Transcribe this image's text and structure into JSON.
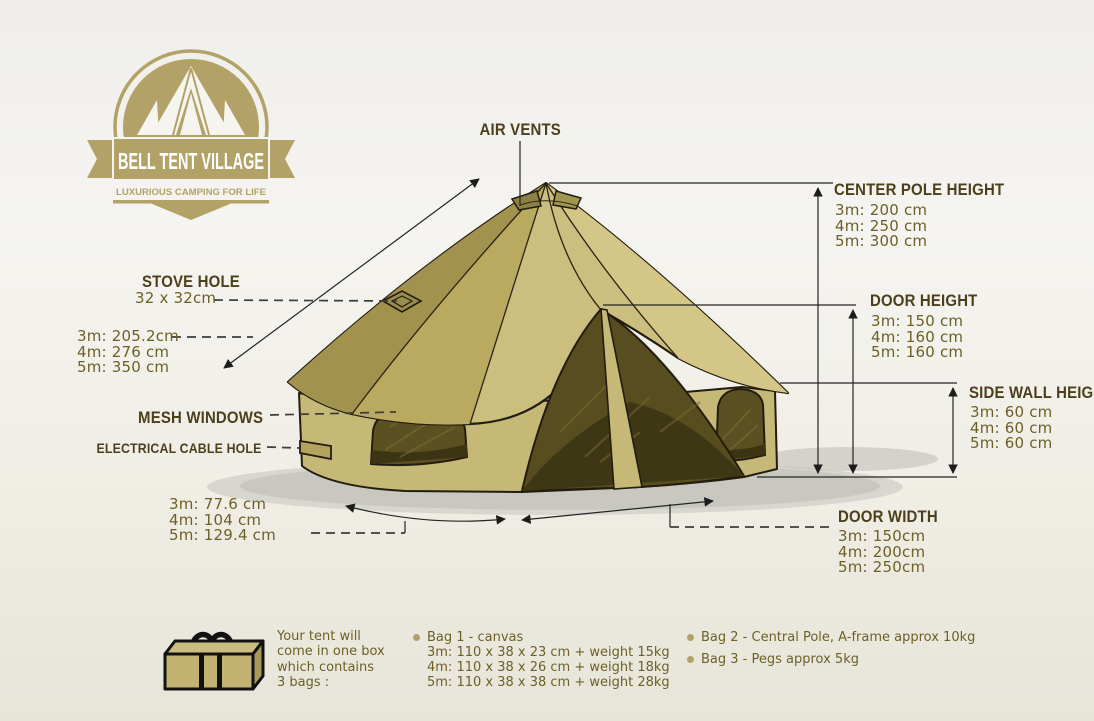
{
  "logo": {
    "title": "BELL TENT VILLAGE",
    "tagline": "LUXURIOUS CAMPING FOR LIFE"
  },
  "labels": {
    "air_vents": "AIR VENTS",
    "center_pole": {
      "title": "CENTER POLE HEIGHT",
      "values": [
        "3m: 200 cm",
        "4m: 250 cm",
        "5m: 300 cm"
      ]
    },
    "door_height": {
      "title": "DOOR HEIGHT",
      "values": [
        "3m: 150 cm",
        "4m: 160 cm",
        "5m: 160 cm"
      ]
    },
    "side_wall": {
      "title": "SIDE WALL HEIGHT",
      "values": [
        "3m: 60 cm",
        "4m: 60 cm",
        "5m: 60 cm"
      ]
    },
    "stove_hole": {
      "title": "STOVE HOLE",
      "value": "32 x 32cm"
    },
    "slant_height": {
      "values": [
        "3m: 205.2cm",
        "4m: 276 cm",
        "5m: 350 cm"
      ]
    },
    "mesh_windows": "MESH WINDOWS",
    "electrical_cable_hole": "ELECTRICAL CABLE HOLE",
    "base_width": {
      "values": [
        "3m: 77.6 cm",
        "4m: 104 cm",
        "5m: 129.4 cm"
      ]
    },
    "door_width": {
      "title": "DOOR WIDTH",
      "values": [
        "3m: 150cm",
        "4m: 200cm",
        "5m: 250cm"
      ]
    }
  },
  "packing": {
    "intro": [
      "Your tent will",
      "come in one box",
      "which contains",
      "3 bags :"
    ],
    "bag1": {
      "title": "Bag 1 - canvas",
      "lines": [
        "3m: 110 x 38 x 23 cm + weight 15kg",
        "4m: 110 x 38 x 26 cm + weight 18kg",
        "5m: 110 x 38 x 38 cm + weight 28kg"
      ]
    },
    "bag2": "Bag 2 - Central Pole, A-frame approx 10kg",
    "bag3": "Bag 3 - Pegs approx 5kg"
  },
  "colors": {
    "accent_gold": "#b3a267",
    "heading": "#4c3f1c",
    "value_text": "#6d6027",
    "tent_tan": "#cbbe7f",
    "mesh_dark": "#584d1f"
  }
}
